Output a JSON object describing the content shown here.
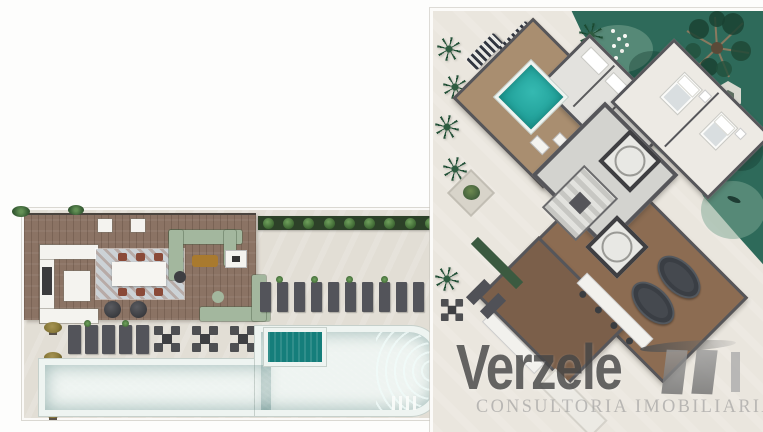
{
  "brand": {
    "name_display": "Verzele",
    "name_suffix": "i",
    "full_name": "Verzeletti",
    "tagline": "CONSULTORIA IMOBILIARIA"
  },
  "palette": {
    "pool": "#2eb6ae",
    "pool_deep": "#1b9a92",
    "pool_dark": "#157e7b",
    "rim": "#eef4f1",
    "lawn": "#2e6a5a",
    "lawn_light": "#7da893",
    "deck": "#8b7364",
    "deck_dark": "#6f5b4e",
    "deck_apt": "#a98e70",
    "wood": "#8c6c52",
    "wood_dark": "#7b5f4a",
    "pavement": "#e2ded5",
    "pavement_2": "#eae6de",
    "wall": "#56565a",
    "room": "#e9e7e2",
    "core": "#d3d3cf",
    "sofa": "#a3b79e",
    "lounge": "#53545a",
    "rust": "#8a4a38",
    "gold": "#a97a2e",
    "hedge": "#2c4128",
    "shrub": "#6fa05c",
    "olive": "#8a7a3a",
    "pot": "#5a5248",
    "white": "#f4f3ef",
    "mark": "#474747",
    "mark_light": "#ababab",
    "tagline": "#9a9a9a"
  },
  "plan": {
    "terrace": {
      "hedge_shrubs": 10,
      "loungers_right": 10,
      "loungers_left": 5,
      "dining_sets": 3,
      "edge_plants": 4,
      "dining_chairs_per_side": 3
    },
    "penthouse": {
      "palms": 6,
      "elevators": 2,
      "dining_ovals": 2,
      "beds": 2,
      "striped_loungers": 2
    }
  }
}
